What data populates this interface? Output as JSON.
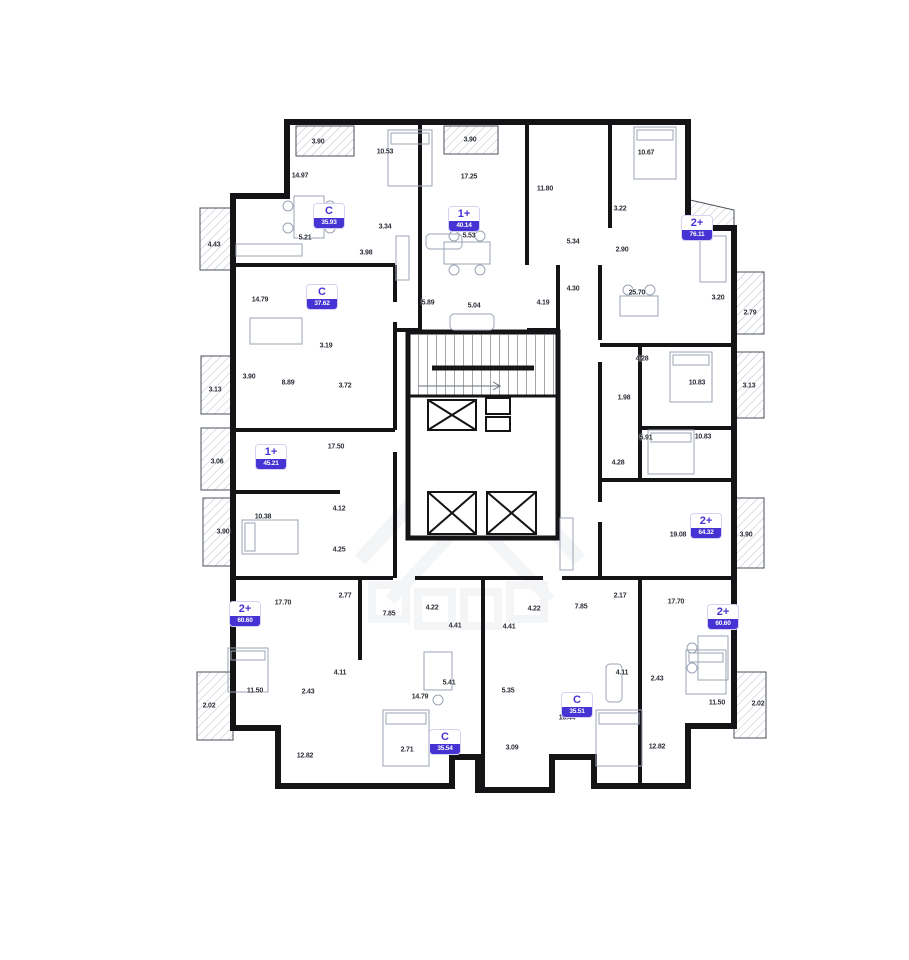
{
  "colors": {
    "accent": "#4633d4",
    "wall": "#141417",
    "hatch": "#b6bdc9",
    "label": "#2c2f38",
    "furniture": "#9aa3b5"
  },
  "plan": {
    "units": [
      {
        "type": "C",
        "area": "35.93",
        "x": 329,
        "y": 216
      },
      {
        "type": "1+",
        "area": "40.14",
        "x": 464,
        "y": 219
      },
      {
        "type": "2+",
        "area": "76.11",
        "x": 697,
        "y": 228
      },
      {
        "type": "C",
        "area": "37.62",
        "x": 322,
        "y": 297
      },
      {
        "type": "1+",
        "area": "45.21",
        "x": 271,
        "y": 457
      },
      {
        "type": "2+",
        "area": "64.32",
        "x": 706,
        "y": 526
      },
      {
        "type": "2+",
        "area": "60.60",
        "x": 245,
        "y": 614
      },
      {
        "type": "2+",
        "area": "60.60",
        "x": 723,
        "y": 617
      },
      {
        "type": "C",
        "area": "35.54",
        "x": 445,
        "y": 742
      },
      {
        "type": "C",
        "area": "35.51",
        "x": 577,
        "y": 705
      }
    ],
    "room_labels": [
      {
        "t": "3.90",
        "x": 318,
        "y": 142
      },
      {
        "t": "10.53",
        "x": 385,
        "y": 152
      },
      {
        "t": "3.90",
        "x": 470,
        "y": 140
      },
      {
        "t": "14.97",
        "x": 300,
        "y": 176
      },
      {
        "t": "17.25",
        "x": 469,
        "y": 177
      },
      {
        "t": "11.80",
        "x": 545,
        "y": 189
      },
      {
        "t": "10.67",
        "x": 646,
        "y": 153
      },
      {
        "t": "3.22",
        "x": 620,
        "y": 209
      },
      {
        "t": "5.21",
        "x": 305,
        "y": 238
      },
      {
        "t": "3.34",
        "x": 385,
        "y": 227
      },
      {
        "t": "3.98",
        "x": 366,
        "y": 253
      },
      {
        "t": "5.53",
        "x": 469,
        "y": 236
      },
      {
        "t": "4.43",
        "x": 214,
        "y": 245
      },
      {
        "t": "5.34",
        "x": 573,
        "y": 242
      },
      {
        "t": "2.90",
        "x": 622,
        "y": 250
      },
      {
        "t": "4.30",
        "x": 573,
        "y": 289
      },
      {
        "t": "25.70",
        "x": 637,
        "y": 293
      },
      {
        "t": "3.20",
        "x": 718,
        "y": 298
      },
      {
        "t": "2.79",
        "x": 750,
        "y": 313
      },
      {
        "t": "5.89",
        "x": 428,
        "y": 303
      },
      {
        "t": "5.04",
        "x": 474,
        "y": 306
      },
      {
        "t": "4.19",
        "x": 543,
        "y": 303
      },
      {
        "t": "14.79",
        "x": 260,
        "y": 300
      },
      {
        "t": "3.19",
        "x": 326,
        "y": 346
      },
      {
        "t": "3.90",
        "x": 249,
        "y": 377
      },
      {
        "t": "8.89",
        "x": 288,
        "y": 383
      },
      {
        "t": "3.72",
        "x": 345,
        "y": 386
      },
      {
        "t": "3.13",
        "x": 215,
        "y": 390
      },
      {
        "t": "4.28",
        "x": 642,
        "y": 359
      },
      {
        "t": "10.83",
        "x": 697,
        "y": 383
      },
      {
        "t": "3.13",
        "x": 749,
        "y": 386
      },
      {
        "t": "1.98",
        "x": 624,
        "y": 398
      },
      {
        "t": "5.91",
        "x": 646,
        "y": 438
      },
      {
        "t": "10.83",
        "x": 703,
        "y": 437
      },
      {
        "t": "4.28",
        "x": 618,
        "y": 463
      },
      {
        "t": "3.06",
        "x": 217,
        "y": 462
      },
      {
        "t": "17.50",
        "x": 336,
        "y": 447
      },
      {
        "t": "4.12",
        "x": 339,
        "y": 509
      },
      {
        "t": "10.38",
        "x": 263,
        "y": 517
      },
      {
        "t": "3.90",
        "x": 223,
        "y": 532
      },
      {
        "t": "4.25",
        "x": 339,
        "y": 550
      },
      {
        "t": "19.08",
        "x": 678,
        "y": 535
      },
      {
        "t": "3.90",
        "x": 746,
        "y": 535
      },
      {
        "t": "2.17",
        "x": 620,
        "y": 596
      },
      {
        "t": "17.70",
        "x": 676,
        "y": 602
      },
      {
        "t": "17.70",
        "x": 283,
        "y": 603
      },
      {
        "t": "2.77",
        "x": 345,
        "y": 596
      },
      {
        "t": "7.85",
        "x": 389,
        "y": 614
      },
      {
        "t": "4.22",
        "x": 432,
        "y": 608
      },
      {
        "t": "4.41",
        "x": 455,
        "y": 626
      },
      {
        "t": "4.41",
        "x": 509,
        "y": 627
      },
      {
        "t": "4.22",
        "x": 534,
        "y": 609
      },
      {
        "t": "7.85",
        "x": 581,
        "y": 607
      },
      {
        "t": "4.11",
        "x": 340,
        "y": 673
      },
      {
        "t": "2.43",
        "x": 308,
        "y": 692
      },
      {
        "t": "11.50",
        "x": 255,
        "y": 691
      },
      {
        "t": "2.02",
        "x": 209,
        "y": 706
      },
      {
        "t": "12.82",
        "x": 305,
        "y": 756
      },
      {
        "t": "2.71",
        "x": 407,
        "y": 750
      },
      {
        "t": "5.41",
        "x": 449,
        "y": 683
      },
      {
        "t": "14.79",
        "x": 420,
        "y": 697
      },
      {
        "t": "5.35",
        "x": 508,
        "y": 691
      },
      {
        "t": "16.44",
        "x": 567,
        "y": 718
      },
      {
        "t": "3.09",
        "x": 512,
        "y": 748
      },
      {
        "t": "4.11",
        "x": 622,
        "y": 673
      },
      {
        "t": "2.43",
        "x": 657,
        "y": 679
      },
      {
        "t": "11.50",
        "x": 717,
        "y": 703
      },
      {
        "t": "2.02",
        "x": 758,
        "y": 704
      },
      {
        "t": "12.82",
        "x": 657,
        "y": 747
      }
    ]
  }
}
